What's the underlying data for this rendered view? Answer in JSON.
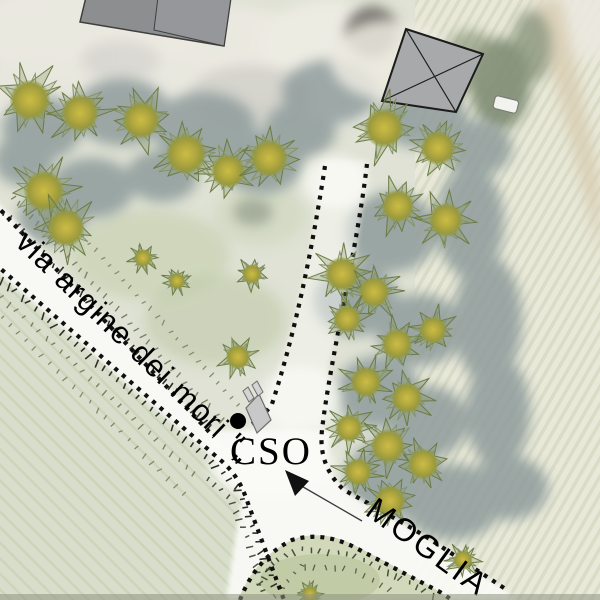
{
  "map": {
    "title": "aerial site plan with vector overlay",
    "labels": {
      "road": "via argine dei mori \"„",
      "cso": "CSO",
      "moglia": "MOGLIA"
    },
    "colors": {
      "dotted_line": "#101010",
      "tree_core": "#c5b542",
      "tree_spike": "#6c7b45",
      "building_roof_gray": "#8c8e90",
      "barn_diamond_gray": "#a7a9ab",
      "road_white": "#fafaf6",
      "field_right": "#e8e9d9",
      "field_bottom_left": "#d8decb",
      "canopy_shadow": "#8f9c9c"
    },
    "features": {
      "dotted_paths": [
        "M -6 203 L 214 437",
        "M -6 263 L 218 458 Q 238 474 246 498 L 284 600",
        "M 325 166 C 312 250 296 330 272 404 Q 262 418 252 424",
        "M 367 164 C 357 250 330 360 322 430 Q 318 466 344 490 Q 390 515 428 538 L 504 588",
        "M 240 600 Q 256 558 292 540 Q 322 531 354 547 Q 396 569 440 592 L 452 600"
      ],
      "hatch_rows": [
        {
          "pts": [
            [
              0,
              213
            ],
            [
              212,
              436
            ]
          ],
          "side": 1,
          "len": 7,
          "sp": 8,
          "c": "#2f2f28",
          "w": 1.6
        },
        {
          "pts": [
            [
              0,
              274
            ],
            [
              216,
              462
            ],
            [
              240,
              486
            ],
            [
              250,
              512
            ],
            [
              280,
              592
            ]
          ],
          "side": -1,
          "len": 7,
          "sp": 9,
          "c": "#2f2f28",
          "w": 1.6
        },
        {
          "pts": [
            [
              8,
              196
            ],
            [
              220,
              424
            ]
          ],
          "side": 1,
          "len": 6,
          "sp": 9,
          "c": "#7c8366",
          "w": 1.4
        },
        {
          "pts": [
            [
              30,
              182
            ],
            [
              238,
              408
            ]
          ],
          "side": 1,
          "len": 5,
          "sp": 10,
          "c": "#868d70",
          "w": 1.3
        },
        {
          "pts": [
            [
              0,
              292
            ],
            [
              202,
              478
            ]
          ],
          "side": -1,
          "len": 6,
          "sp": 10,
          "c": "#79815f",
          "w": 1.4
        },
        {
          "pts": [
            [
              0,
              312
            ],
            [
              186,
              492
            ]
          ],
          "side": -1,
          "len": 5,
          "sp": 11,
          "c": "#828a68",
          "w": 1.3
        },
        {
          "pts": [
            [
              206,
              474
            ],
            [
              234,
              498
            ],
            [
              252,
              542
            ],
            [
              266,
              592
            ]
          ],
          "side": -1,
          "len": 6,
          "sp": 9,
          "c": "#4a5240",
          "w": 1.5
        },
        {
          "pts": [
            [
              254,
              588
            ],
            [
              272,
              560
            ],
            [
              298,
              546
            ],
            [
              352,
              552
            ],
            [
              398,
              574
            ],
            [
              436,
              594
            ]
          ],
          "side": -1,
          "len": 6,
          "sp": 9,
          "c": "#454f3c",
          "w": 1.5
        },
        {
          "pts": [
            [
              270,
              598
            ],
            [
              300,
              564
            ],
            [
              352,
              566
            ],
            [
              396,
              590
            ]
          ],
          "side": -1,
          "len": 5,
          "sp": 10,
          "c": "#5a6348",
          "w": 1.3
        }
      ],
      "trees": [
        [
          30,
          100,
          25
        ],
        [
          80,
          113,
          23
        ],
        [
          141,
          120,
          23
        ],
        [
          186,
          154,
          25
        ],
        [
          228,
          171,
          21
        ],
        [
          269,
          158,
          23
        ],
        [
          44,
          191,
          25
        ],
        [
          66,
          228,
          23
        ],
        [
          143,
          258,
          11
        ],
        [
          177,
          281,
          10
        ],
        [
          252,
          274,
          12
        ],
        [
          238,
          357,
          15
        ],
        [
          384,
          128,
          24
        ],
        [
          438,
          148,
          21
        ],
        [
          398,
          206,
          20
        ],
        [
          446,
          220,
          21
        ],
        [
          342,
          274,
          21
        ],
        [
          374,
          292,
          19
        ],
        [
          347,
          319,
          17
        ],
        [
          397,
          344,
          19
        ],
        [
          433,
          330,
          17
        ],
        [
          366,
          382,
          19
        ],
        [
          407,
          398,
          19
        ],
        [
          349,
          428,
          17
        ],
        [
          388,
          446,
          21
        ],
        [
          423,
          464,
          19
        ],
        [
          358,
          472,
          17
        ],
        [
          390,
          501,
          19
        ],
        [
          463,
          560,
          12
        ],
        [
          310,
          594,
          10
        ]
      ]
    }
  }
}
